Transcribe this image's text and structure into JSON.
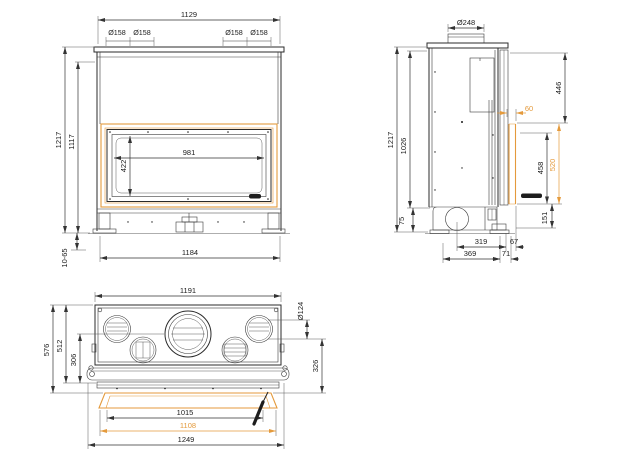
{
  "colors": {
    "accent": "#e49a3c",
    "line": "#2b2b2b"
  },
  "front": {
    "width_top": "1129",
    "flue_left_1": "Ø158",
    "flue_left_2": "Ø158",
    "flue_right_1": "Ø158",
    "flue_right_2": "Ø158",
    "height_total": "1217",
    "height_body": "1117",
    "glass_width": "981",
    "glass_height": "422",
    "width_base": "1184",
    "feet_range": "10-65"
  },
  "side": {
    "flue_dia": "Ø248",
    "height_total": "1217",
    "height_body": "1026",
    "top_to_frame": "446",
    "frame_offset": "60",
    "door_height": "458",
    "frame_height": "520",
    "base_front_height": "151",
    "base_rear_height": "75",
    "flue_to_front": "319",
    "front_lip": "67",
    "base_depth": "369",
    "frame_depth": "71"
  },
  "plan": {
    "width_body": "1191",
    "outlet_dia": "Ø124",
    "depth_total": "576",
    "depth_body": "512",
    "flue_to_front": "306",
    "side_depth": "326",
    "frame_inner_width": "1015",
    "frame_width": "1108",
    "width_total": "1249"
  }
}
